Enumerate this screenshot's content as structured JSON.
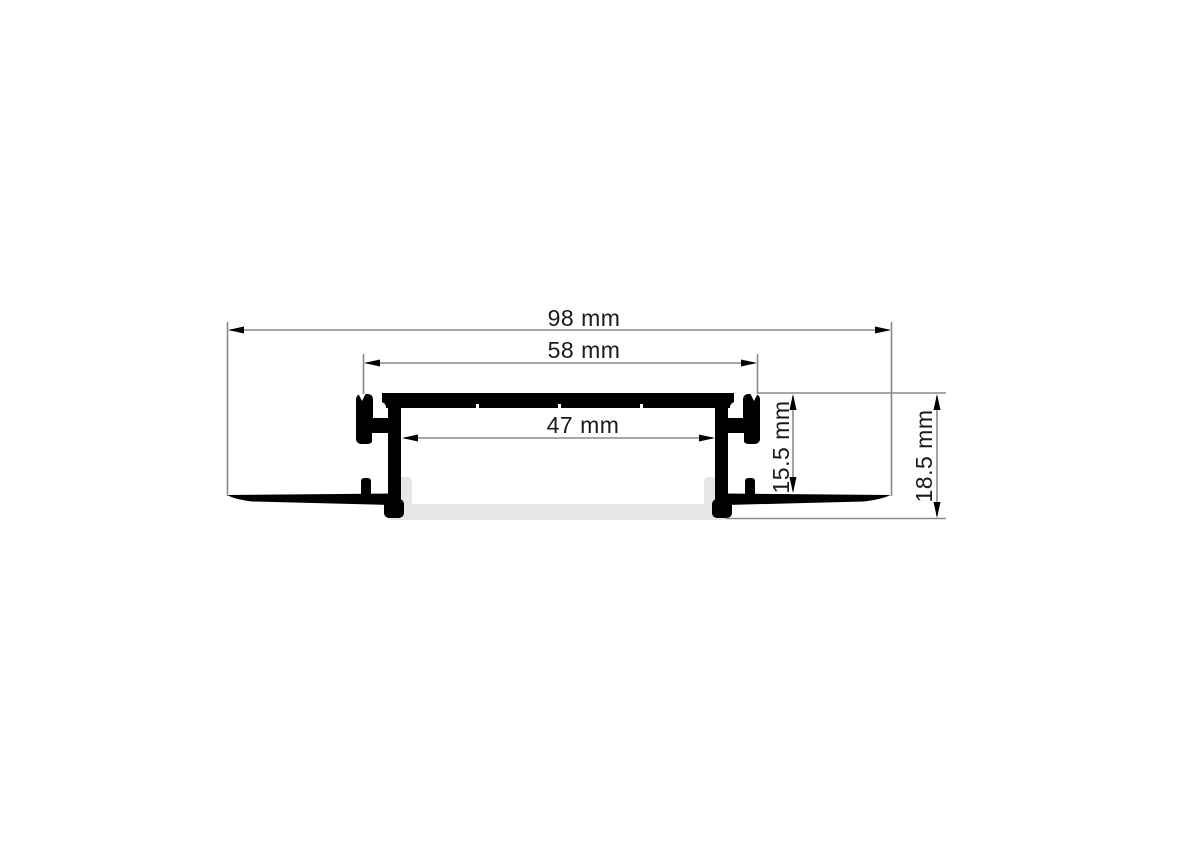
{
  "drawing": {
    "kind": "led-profile-cross-section-dimension-drawing",
    "dimensions": [
      {
        "id": "overall-width",
        "label": "98 mm"
      },
      {
        "id": "clip-width",
        "label": "58 mm"
      },
      {
        "id": "inner-width",
        "label": "47 mm"
      },
      {
        "id": "recess-depth",
        "label": "15.5 mm"
      },
      {
        "id": "overall-depth",
        "label": "18.5 mm"
      }
    ],
    "colors": {
      "outline": "#000000",
      "diffuser": "#e6e6e6",
      "dimension_line": "#8a8a8a",
      "arrow": "#000000",
      "background": "#ffffff"
    }
  }
}
